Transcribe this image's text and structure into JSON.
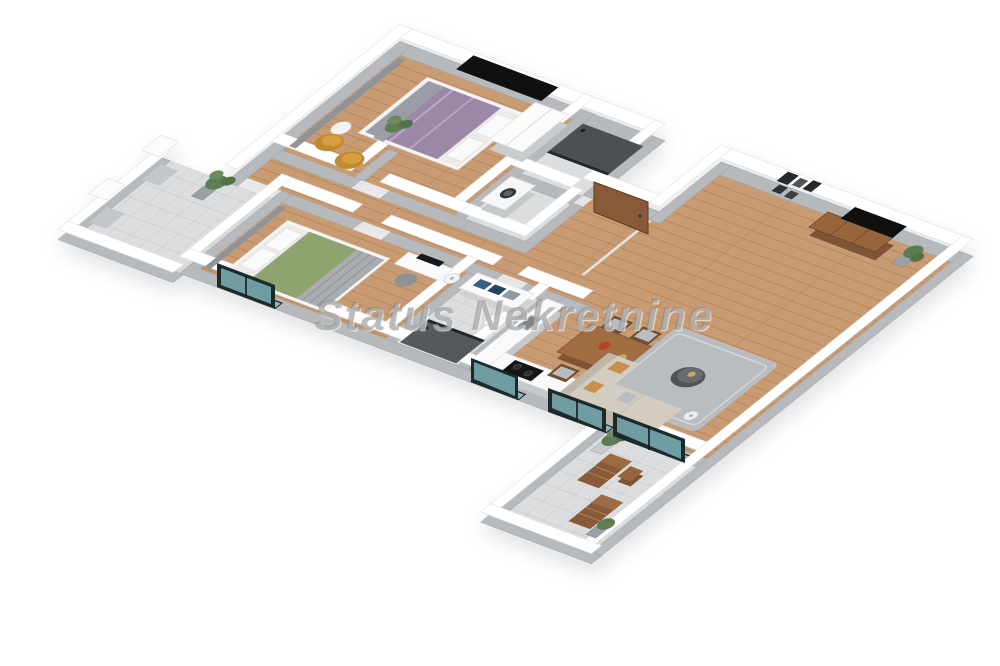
{
  "image": {
    "type": "isometric-3d-floor-plan-render",
    "width": 1000,
    "height": 666,
    "background": "#ffffff"
  },
  "watermark": {
    "text": "Status Nekretnine"
  },
  "palette": {
    "wall_cap": "#ffffff",
    "wall_face": "#b7babc",
    "wood_floor": "#c89b72",
    "tile_floor": "#dcdddf",
    "shower_dark": "#4b5054",
    "bed1_blanket": "#9d87a6",
    "bed2_blanket": "#8ea36e",
    "accent_chair": "#c08a2e",
    "sofa": "#d3ccc1",
    "rug": "#b9bdc2",
    "dining_wood": "#a06c42",
    "console_wood": "#96653e",
    "tv": "#101010",
    "plant": "#5e7d52",
    "glass": "#8fb6ba",
    "door_wood": "#8a5a38",
    "lounge_wood": "#8a5a36"
  },
  "rooms": [
    {
      "id": "bedroom-1",
      "furniture": [
        "double-bed-purple",
        "wall-mounted-tv",
        "white-wardrobe",
        "two-accent-chairs",
        "round-side-table",
        "floor-plant",
        "curtains",
        "partition-wall"
      ]
    },
    {
      "id": "bathroom-1",
      "furniture": [
        "dark-walk-in-shower"
      ]
    },
    {
      "id": "laundry-wc",
      "furniture": [
        "washing-machine"
      ]
    },
    {
      "id": "entrance",
      "furniture": [
        "front-door"
      ]
    },
    {
      "id": "hallway",
      "furniture": []
    },
    {
      "id": "bedroom-2",
      "furniture": [
        "double-bed-green",
        "desk-with-monitor",
        "desk-chair",
        "floor-lamp",
        "curtains",
        "balcony-window"
      ]
    },
    {
      "id": "bathroom-2",
      "furniture": [
        "vanity-with-towels",
        "toilet",
        "shower"
      ]
    },
    {
      "id": "kitchen",
      "furniture": [
        "l-shaped-counter",
        "cooktop",
        "sink"
      ]
    },
    {
      "id": "dining-area",
      "furniture": [
        "wood-dining-table",
        "six-chairs",
        "serving-dishes"
      ]
    },
    {
      "id": "living-room",
      "furniture": [
        "sectional-sofa",
        "round-coffee-table",
        "shag-rug",
        "tv-console",
        "wall-mounted-tv",
        "gallery-frames",
        "floor-lamp",
        "potted-plant",
        "sliding-glass-door"
      ]
    },
    {
      "id": "balcony-left",
      "furniture": [
        "potted-plant",
        "two-pillars"
      ]
    },
    {
      "id": "terrace",
      "furniture": [
        "two-lounge-chairs",
        "side-table",
        "potted-plants"
      ]
    }
  ]
}
